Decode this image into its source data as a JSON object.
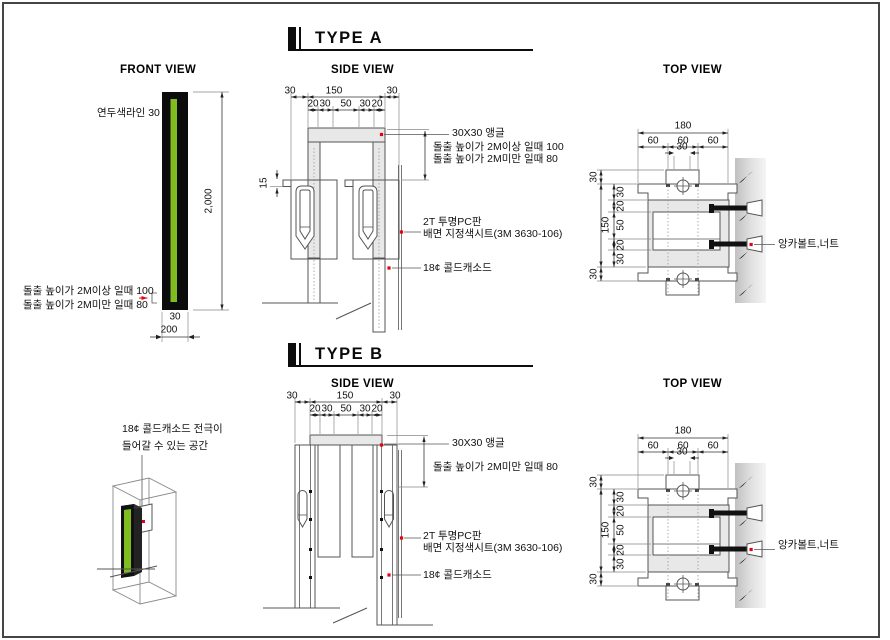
{
  "colors": {
    "accent_green": "#80bc20",
    "marker_red": "#e60012",
    "line": "#555555",
    "fill_gray": "#e8e8e8"
  },
  "header_a": {
    "title": "TYPE A"
  },
  "header_b": {
    "title": "TYPE B"
  },
  "type_a": {
    "front": {
      "title": "FRONT VIEW",
      "green_line_label": "연두색라인 30",
      "height": "2,000",
      "bar_width": "30",
      "base_width": "200",
      "note_over": "돌출 높이가 2M이상 일때 100",
      "note_under": "돌출 높이가 2M미만 일때 80"
    },
    "side": {
      "title": "SIDE VIEW",
      "d_row1": [
        "30",
        "150",
        "30"
      ],
      "d_row2": [
        "20",
        "30",
        "50",
        "30",
        "20"
      ],
      "d15": "15",
      "angle": "30X30 앵글",
      "note_over": "돌출 높이가 2M이상 일때 100",
      "note_under": "돌출 높이가 2M미만 일때 80",
      "pc1": "2T 투명PC판",
      "pc2": "배면 지정색시트(3M 3630-106)",
      "cathode": "18¢ 콜드캐소드"
    },
    "top": {
      "title": "TOP VIEW",
      "d180": "180",
      "d60": [
        "60",
        "60",
        "60"
      ],
      "d30": "30",
      "col_outer": [
        "30",
        "150",
        "30"
      ],
      "col_inner": [
        "30",
        "20",
        "50",
        "20",
        "30"
      ],
      "anchor": "앙카볼트,너트"
    }
  },
  "type_b": {
    "iso": {
      "note1": "18¢ 콜드캐소드 전극이",
      "note2": "들어갈 수 있는 공간"
    },
    "side": {
      "title": "SIDE VIEW",
      "d_row1": [
        "30",
        "150",
        "30"
      ],
      "d_row2": [
        "20",
        "30",
        "50",
        "30",
        "20"
      ],
      "angle": "30X30 앵글",
      "note_under": "돌출 높이가 2M미만 일때 80",
      "pc1": "2T 투명PC판",
      "pc2": "배면 지정색시트(3M 3630-106)",
      "cathode": "18¢ 콜드캐소드"
    },
    "top": {
      "title": "TOP VIEW",
      "d180": "180",
      "d60": [
        "60",
        "60",
        "60"
      ],
      "d30": "30",
      "col_outer": [
        "30",
        "150",
        "30"
      ],
      "col_inner": [
        "30",
        "20",
        "50",
        "20",
        "30"
      ],
      "anchor": "앙카볼트,너트"
    }
  }
}
